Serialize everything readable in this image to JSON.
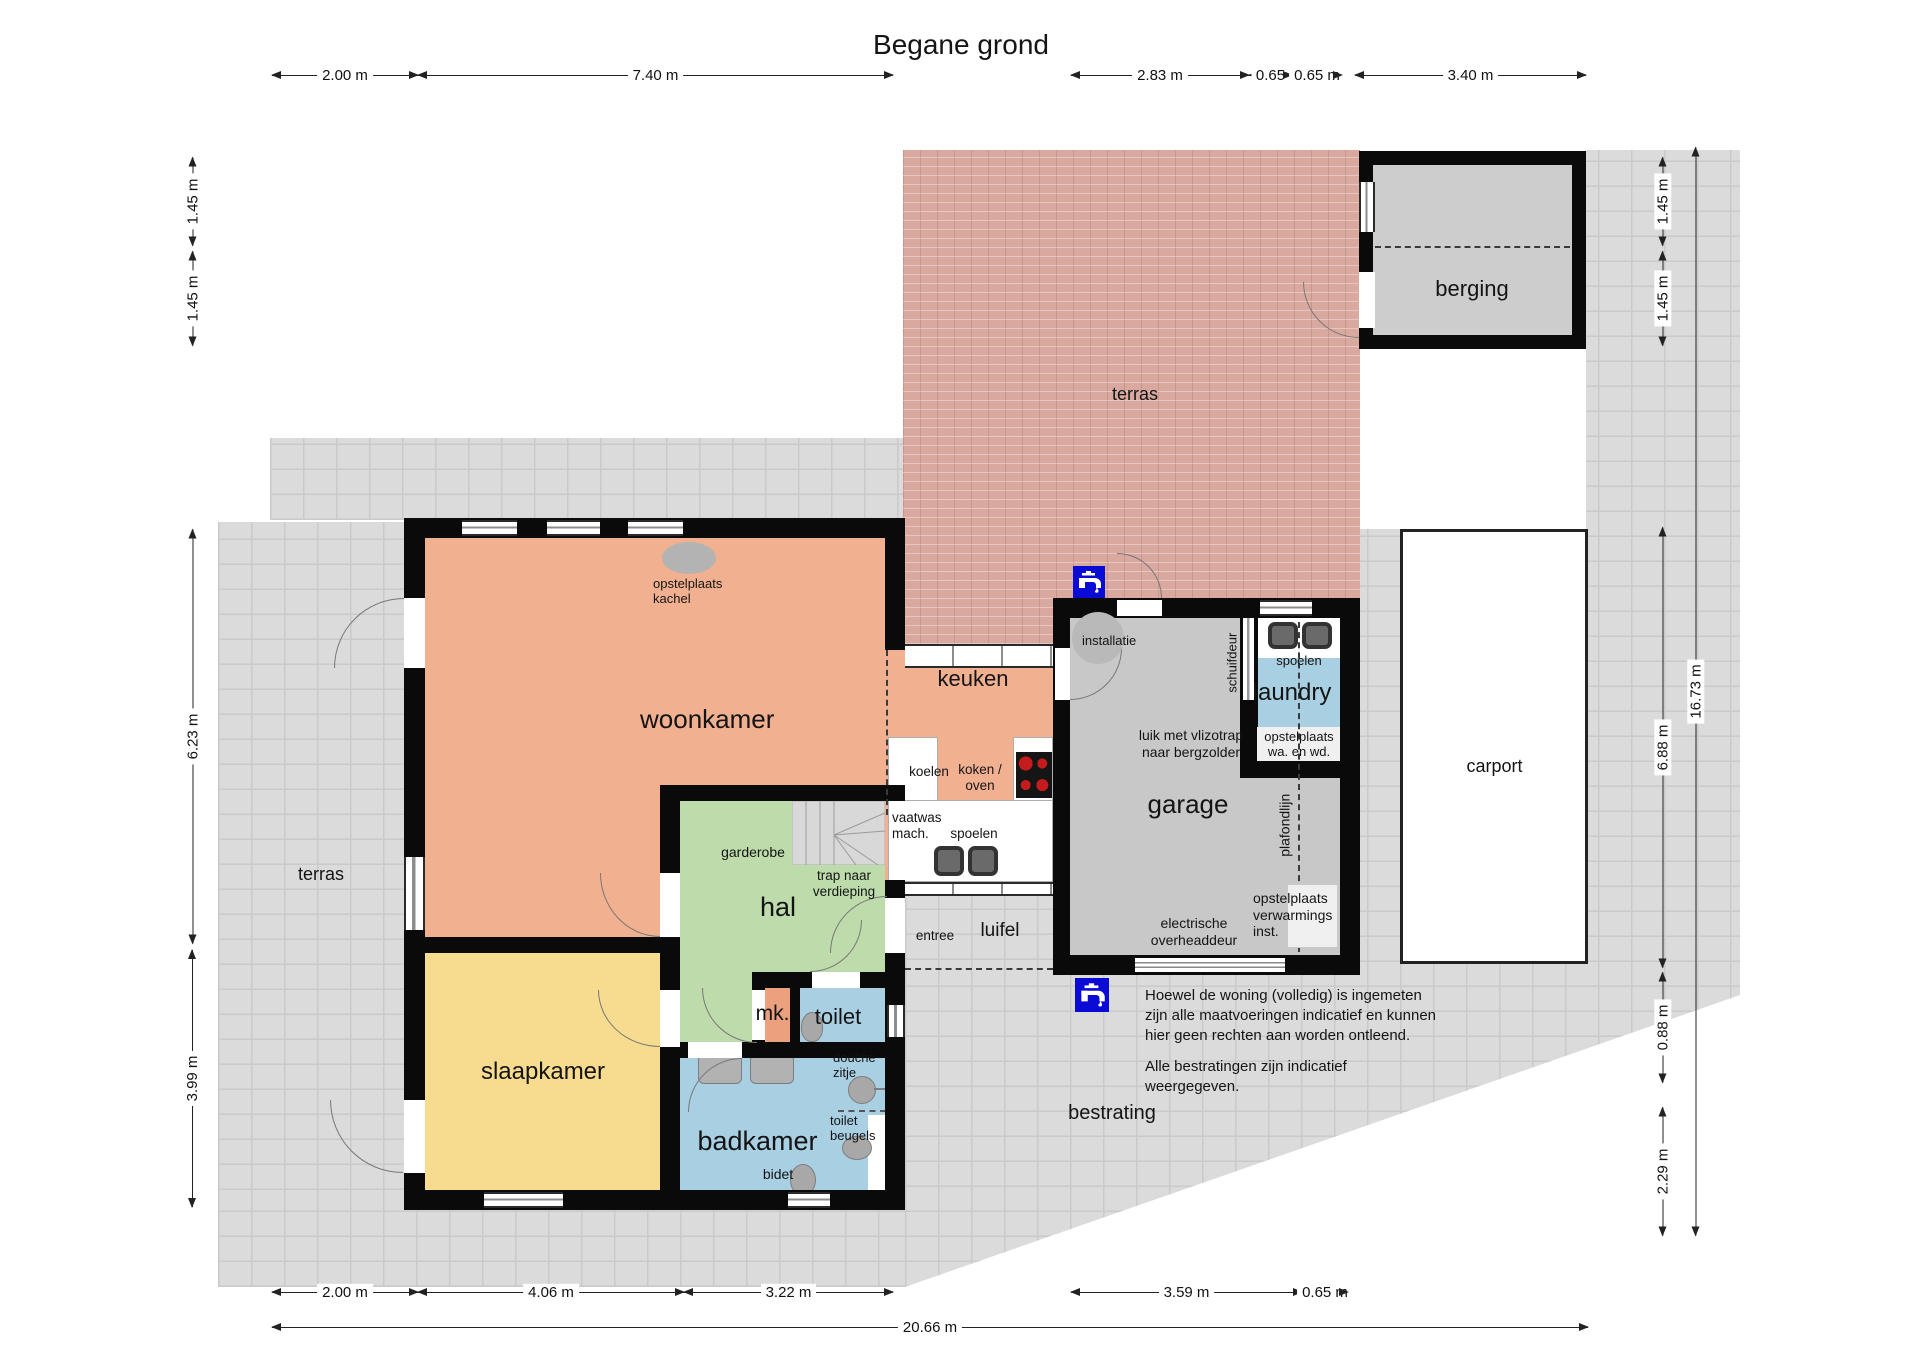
{
  "title": "Begane grond",
  "rooms": {
    "woonkamer": "woonkamer",
    "keuken": "keuken",
    "hal": "hal",
    "slaapkamer": "slaapkamer",
    "badkamer": "badkamer",
    "toilet": "toilet",
    "mk": "mk.",
    "garage": "garage",
    "laundry": "laundry",
    "berging": "berging",
    "carport": "carport",
    "terras_top": "terras",
    "terras_left": "terras",
    "bestrating": "bestrating",
    "luifel": "luifel",
    "entree": "entree"
  },
  "labels": {
    "opstelplaats_kachel": "opstelplaats kachel",
    "installatie": "installatie",
    "schuifdeur": "schuifdeur",
    "spoelen_laundry": "spoelen",
    "opstelplaats_wa_wd": "opstelplaats wa. en wd.",
    "luik": "luik met vlizotrap naar bergzolder",
    "plafondlijn": "plafondlijn",
    "opstelplaats_verwarming": "opstelplaats verwarmings inst.",
    "overheaddeur": "electrische overheaddeur",
    "koelen": "koelen",
    "koken_oven": "koken / oven",
    "vaatwas": "vaatwas mach.",
    "spoelen_keuken": "spoelen",
    "garderobe": "garderobe",
    "trap": "trap naar verdieping",
    "douche_zitje": "douche zitje",
    "toilet_beugels": "toilet beugels",
    "bidet": "bidet"
  },
  "notes": {
    "measure": "Hoewel de woning (volledig) is ingemeten zijn alle maatvoeringen indicatief en kunnen hier geen rechten aan worden ontleend.",
    "paving": "Alle bestratingen zijn indicatief weergegeven."
  },
  "dims": {
    "top": [
      "2.00 m",
      "7.40 m",
      "2.83 m",
      "0.65",
      "0.65 m",
      "3.40 m"
    ],
    "bottom": [
      "2.00 m",
      "4.06 m",
      "3.22 m",
      "3.59 m",
      "0.65 m",
      "20.66 m"
    ],
    "left": [
      "1.45 m",
      "1.45 m",
      "6.23 m",
      "3.99 m"
    ],
    "right": [
      "1.45 m",
      "1.45 m",
      "6.88 m",
      "0.88 m",
      "2.29 m",
      "16.73 m"
    ]
  },
  "colors": {
    "living_orange": "#f1b190",
    "mk_orange": "#eba07e",
    "hall_green": "#bedcab",
    "bedroom_yellow": "#f7dc90",
    "bath_blue": "#a9cfe3",
    "garage_gray": "#c8c8c8",
    "brick_terras": "#d9a89e",
    "paving_gray": "#dbdbdb",
    "wall_black": "#0a0a0a",
    "tap_blue": "#0b0bd6",
    "burner_red": "#c41c1c"
  }
}
